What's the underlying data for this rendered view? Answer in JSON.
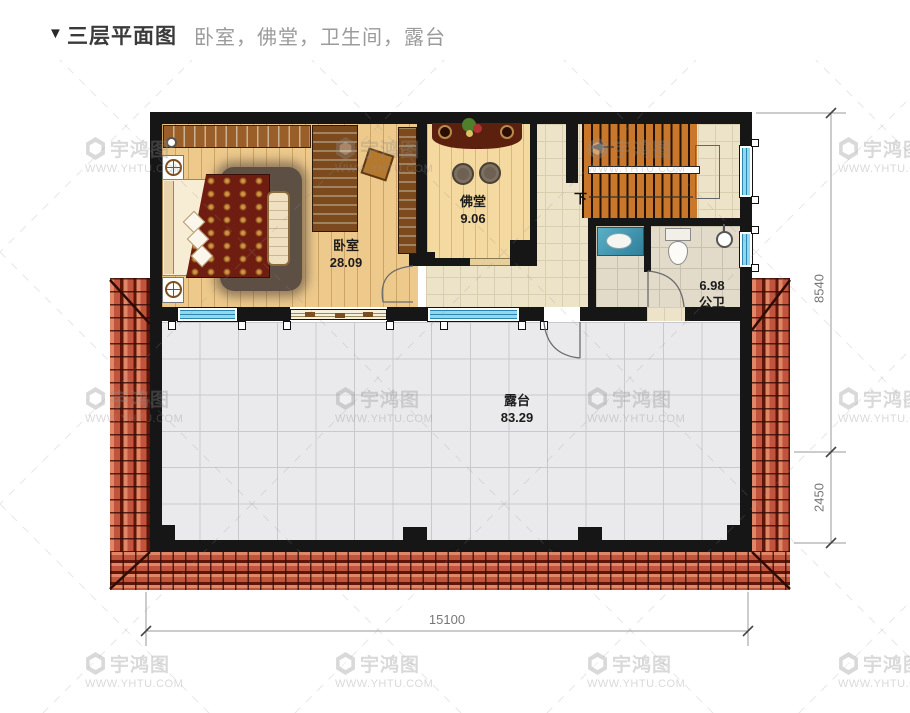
{
  "header": {
    "marker": "▼",
    "title": "三层平面图",
    "subtitle": "卧室，佛堂，卫生间，露台"
  },
  "rooms": {
    "bedroom": {
      "name": "卧室",
      "area": "28.09"
    },
    "buddha_hall": {
      "name": "佛堂",
      "area": "9.06"
    },
    "bathroom": {
      "area": "6.98",
      "name": "公卫"
    },
    "terrace": {
      "name": "露台",
      "area": "83.29"
    }
  },
  "stairs": {
    "direction_label": "下"
  },
  "dimensions": {
    "right_upper": "8540",
    "right_lower": "2450",
    "bottom_width": "15100"
  },
  "watermark": {
    "brand": "宇鸿图",
    "site": "WWW.YHTU.COM"
  },
  "colors": {
    "wall": "#161616",
    "roof_tile": "#c2543d",
    "window_glass": "#8ed9f2",
    "stair_tread": "#c8772b",
    "wood_floor": "#edc98c",
    "terrace_floor": "#eaeaec",
    "dimension_text": "#777777"
  }
}
